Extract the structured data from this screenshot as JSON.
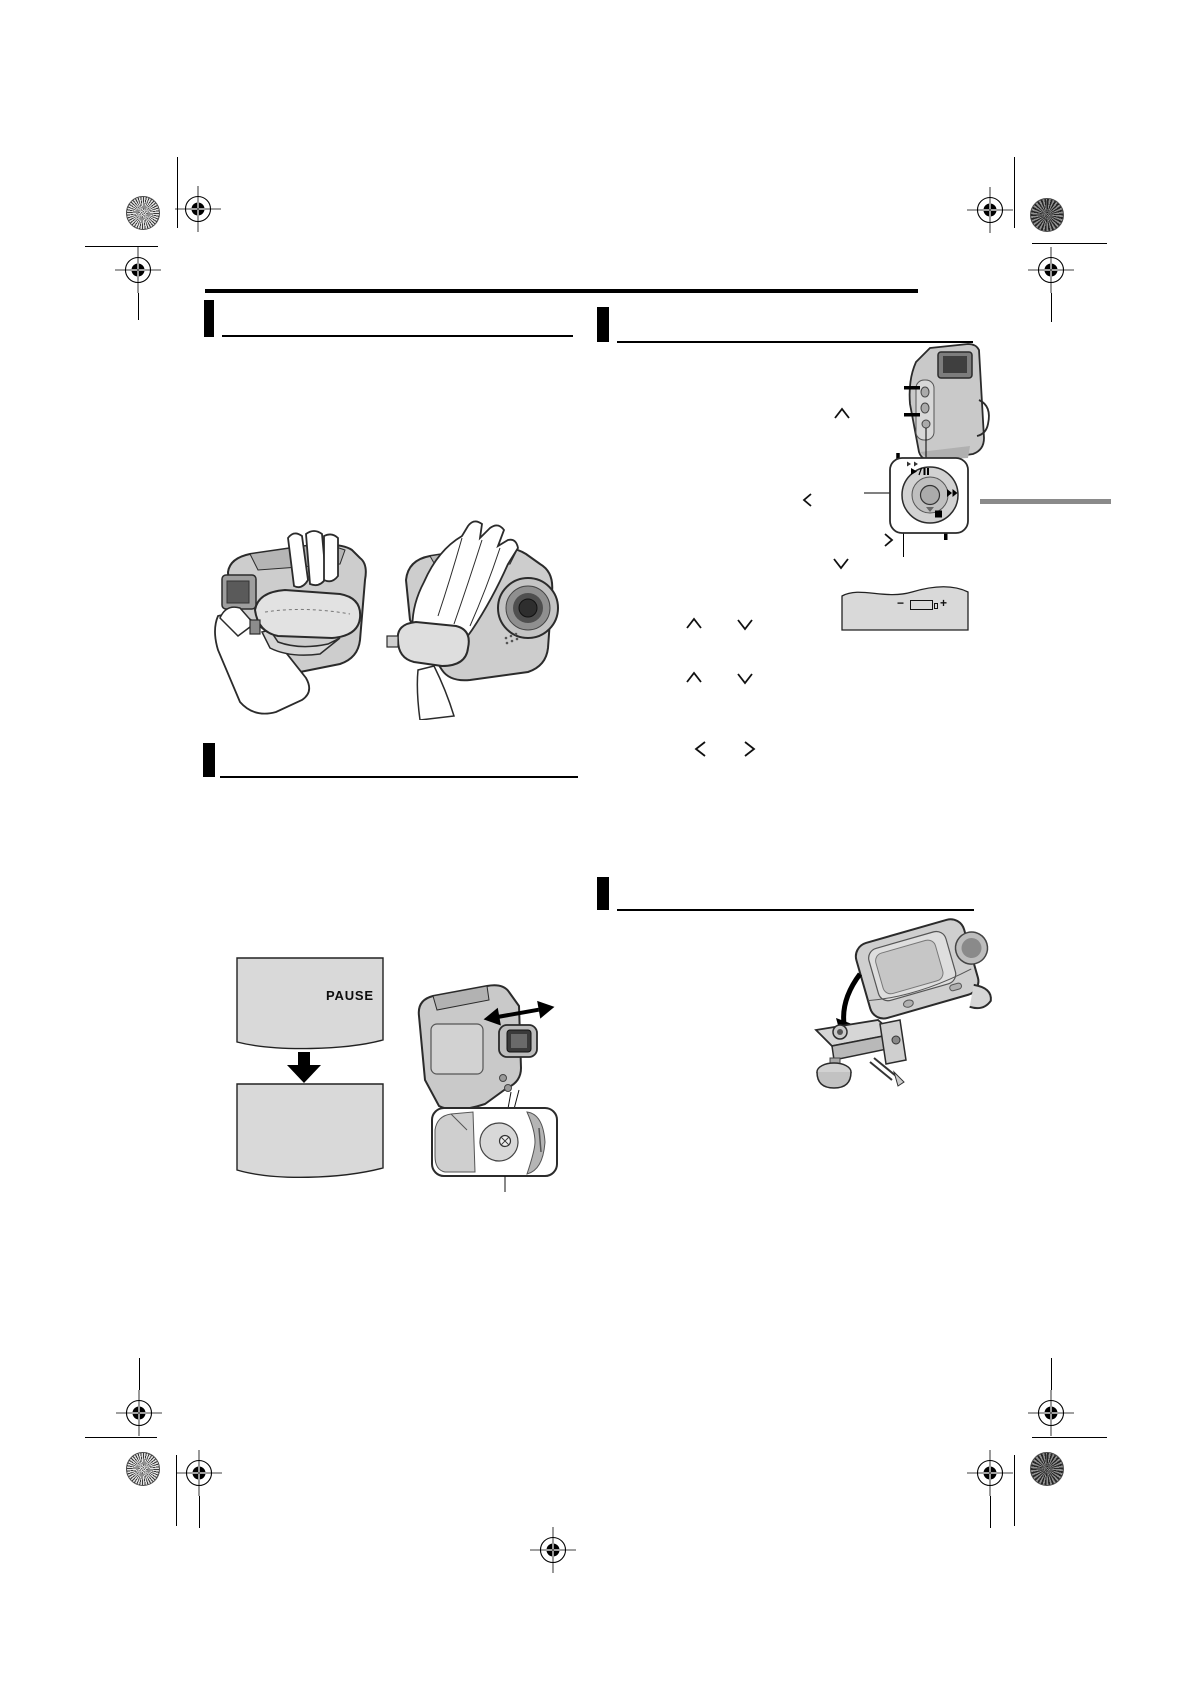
{
  "document": {
    "type": "camcorder-instruction-manual-page",
    "note": "print-proof page; body text layer not rendered, only rules, printer registration marks and illustrations are visible",
    "background": "#ffffff"
  },
  "colors": {
    "rule_black": "#000000",
    "section_tab_gray": "#8a8a8a",
    "screen_gray": "#d9d9d9",
    "illustration_gray": "#c9c9c9",
    "outline_dark": "#2b2b2b"
  },
  "screens": {
    "pause_label": "PAUSE"
  },
  "battery_indicator": {
    "minus_label": "−",
    "plus_label": "+"
  },
  "icons": {
    "play_pause": "▶/❙❙",
    "fast_forward": "▶▶",
    "stop": "■",
    "chevron_up": "∧",
    "chevron_down": "∨",
    "chevron_left": "<",
    "chevron_right": ">",
    "down_arrow": "▼",
    "double_arrow": "↔",
    "registration_target": "⊕",
    "color_starburst": "✳"
  }
}
